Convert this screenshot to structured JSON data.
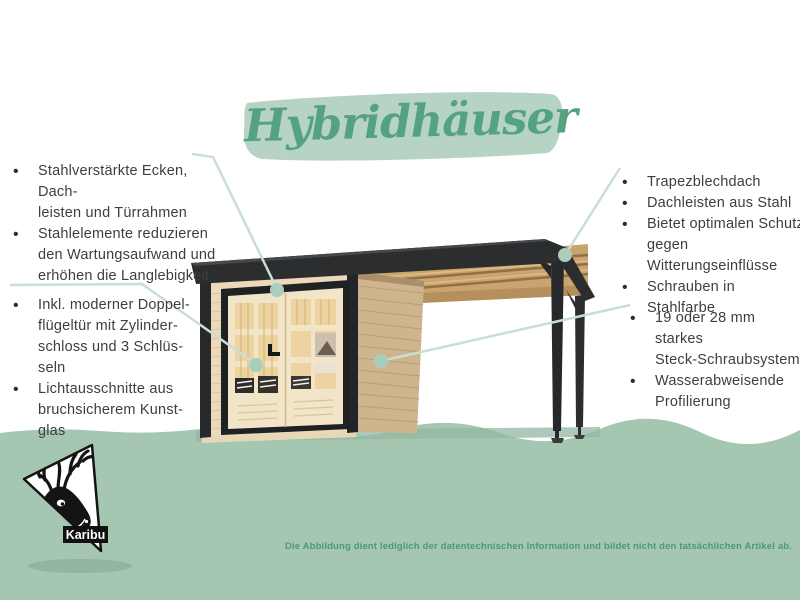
{
  "title": {
    "text": "Hybridhäuser"
  },
  "features_left_top": {
    "items": [
      "Stahlverstärkte Ecken, Dach-\nleisten und Türrahmen",
      "Stahlelemente reduzieren\nden Wartungsaufwand und\nerhöhen die Langlebigkeit"
    ]
  },
  "features_left_bottom": {
    "items": [
      "Inkl. moderner Doppel-\nflügeltür mit Zylinder-\nschloss und 3 Schlüs-\nseln",
      "Lichtausschnitte aus\nbruchsicherem Kunst-\nglas"
    ]
  },
  "features_right_top": {
    "items": [
      "Trapezblechdach",
      "Dachleisten aus Stahl",
      "Bietet optimalen Schutz\ngegen Witterungseinflüsse",
      "Schrauben in Stahlfarbe"
    ]
  },
  "features_right_bottom": {
    "items": [
      "19 oder 28 mm starkes\nSteck-Schraubsystem",
      "Wasserabweisende\nProfilierung"
    ]
  },
  "logo": {
    "brand": "Karibu"
  },
  "footer": {
    "disclaimer": "Die Abbildung dient lediglich der datentechnischen Information und bildet nicht den tatsächlichen Artikel ab."
  },
  "colors": {
    "accent_green": "#55a282",
    "brush_green": "#b7d3c4",
    "callout_line": "#c9dfd3",
    "callout_dot": "#a9cfbc",
    "ground_green": "#a5c6b1",
    "body_text": "#3e3e3e",
    "disclaimer_green": "#4a9b70",
    "roof_dark": "#2b2d2f",
    "wood_front": "#ecd9ba",
    "wood_side": "#cfb58e",
    "wood_beam": "#caa46e"
  }
}
